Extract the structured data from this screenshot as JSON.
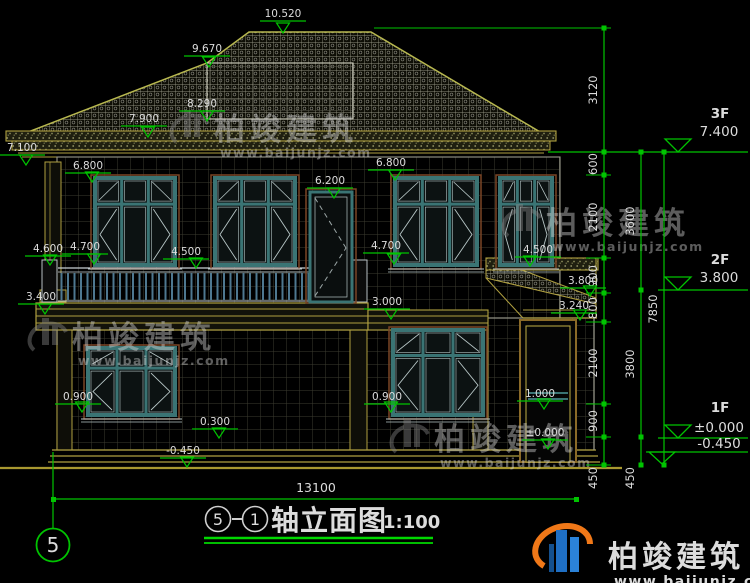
{
  "colors": {
    "background": "#000000",
    "dim_green": "#00c400",
    "text": "#dcdcdc",
    "roof_line": "#b8b850",
    "olive": "#b0a040",
    "wall_line": "#98988a",
    "window_frame": "#3a7474",
    "window_trim": "#7a4526",
    "pane_line": "#b7c6c6",
    "railing": "#4e7890",
    "watermark_gray": "#8a8a8a",
    "logo_blue": "#1f6fc4",
    "logo_orange": "#f07818"
  },
  "footer": {
    "title_axis_start": "5",
    "title_axis_end": "1",
    "title_text": "轴立面图",
    "title_scale": "1:100"
  },
  "axis_bubble": {
    "label": "5"
  },
  "overall_dim": {
    "label": "13100"
  },
  "watermark": {
    "brand": "柏竣建筑",
    "site": "www.baijunjz.com",
    "positions": [
      {
        "x": 166,
        "y": 102
      },
      {
        "x": 24,
        "y": 310
      },
      {
        "x": 498,
        "y": 196
      },
      {
        "x": 386,
        "y": 412
      }
    ]
  },
  "brand_logo": {
    "brand": "柏竣建筑",
    "site": "www.baijunjz.com"
  },
  "elevation_markers": [
    {
      "t": "10.520",
      "x": 283,
      "y": 17,
      "px": 283,
      "py": 33
    },
    {
      "t": "9.670",
      "x": 207,
      "y": 52,
      "px": 209,
      "py": 67
    },
    {
      "t": "8.290",
      "x": 202,
      "y": 107,
      "px": 207,
      "py": 121
    },
    {
      "t": "7.900",
      "x": 144,
      "y": 122,
      "px": 148,
      "py": 137
    },
    {
      "t": "7.100",
      "x": 22,
      "y": 151,
      "px": 26,
      "py": 165
    },
    {
      "t": "6.800",
      "x": 88,
      "y": 169,
      "px": 92,
      "py": 182
    },
    {
      "t": "6.800",
      "x": 391,
      "y": 166,
      "px": 395,
      "py": 180
    },
    {
      "t": "6.200",
      "x": 330,
      "y": 184,
      "px": 334,
      "py": 198
    },
    {
      "t": "4.700",
      "x": 85,
      "y": 250,
      "px": 94,
      "py": 264
    },
    {
      "t": "4.600",
      "x": 48,
      "y": 252,
      "px": 50,
      "py": 265
    },
    {
      "t": "4.500",
      "x": 186,
      "y": 255,
      "px": 196,
      "py": 268
    },
    {
      "t": "4.700",
      "x": 386,
      "y": 249,
      "px": 394,
      "py": 264
    },
    {
      "t": "4.500",
      "x": 538,
      "y": 253,
      "px": 530,
      "py": 266
    },
    {
      "t": "3.800",
      "x": 583,
      "y": 284,
      "px": 590,
      "py": 296
    },
    {
      "t": "3.400",
      "x": 41,
      "y": 300,
      "px": 45,
      "py": 314
    },
    {
      "t": "3.240",
      "x": 574,
      "y": 309,
      "px": 580,
      "py": 320
    },
    {
      "t": "3.000",
      "x": 387,
      "y": 305,
      "px": 391,
      "py": 319
    },
    {
      "t": "0.900",
      "x": 78,
      "y": 400,
      "px": 82,
      "py": 412
    },
    {
      "t": "0.900",
      "x": 387,
      "y": 400,
      "px": 391,
      "py": 412
    },
    {
      "t": "1.000",
      "x": 540,
      "y": 397,
      "px": 544,
      "py": 409
    },
    {
      "t": "±0.000",
      "x": 545,
      "y": 436,
      "px": 548,
      "py": 449
    },
    {
      "t": "0.300",
      "x": 215,
      "y": 425,
      "px": 219,
      "py": 438
    },
    {
      "t": "-0.450",
      "x": 183,
      "y": 454,
      "px": 187,
      "py": 467
    }
  ],
  "dim_chains": [
    {
      "x": 604,
      "y1": 28,
      "y2": 465,
      "ext": true,
      "ticks": [
        28,
        152,
        175,
        258,
        293,
        322,
        404,
        437,
        465
      ],
      "labels": [
        {
          "t": "3120",
          "y": 90
        },
        {
          "t": "600",
          "y": 164
        },
        {
          "t": "2100",
          "y": 217
        },
        {
          "t": "900",
          "y": 276
        },
        {
          "t": "800",
          "y": 308
        },
        {
          "t": "2100",
          "y": 363
        },
        {
          "t": "900",
          "y": 421
        },
        {
          "t": "450",
          "y": 478
        }
      ]
    },
    {
      "x": 641,
      "y1": 152,
      "y2": 465,
      "ext": false,
      "ticks": [
        152,
        290,
        437,
        465
      ],
      "labels": [
        {
          "t": "3600",
          "y": 221
        },
        {
          "t": "3800",
          "y": 364
        },
        {
          "t": "450",
          "y": 478
        }
      ]
    },
    {
      "x": 664,
      "y1": 152,
      "y2": 465,
      "ext": false,
      "ticks": [
        152,
        465
      ],
      "labels": [
        {
          "t": "7850",
          "y": 309
        }
      ]
    }
  ],
  "floor_levels": [
    {
      "name": "3F",
      "value": "7.400",
      "name_y": 118,
      "val_y": 136,
      "line_x1": 548,
      "line_y": 152,
      "tri_cx": 678,
      "tri_base": 139,
      "tri_tip": 152
    },
    {
      "name": "2F",
      "value": "3.800",
      "name_y": 264,
      "val_y": 282,
      "line_x1": 658,
      "line_y": 290,
      "tri_cx": 678,
      "tri_base": 277,
      "tri_tip": 290
    },
    {
      "name": "1F",
      "value": "±0.000",
      "name_y": 412,
      "val_y": 432,
      "line_x1": 658,
      "line_y": 438,
      "tri_cx": 678,
      "tri_base": 425,
      "tri_tip": 438
    },
    {
      "name": "",
      "value": "-0.450",
      "name_y": 0,
      "val_y": 448,
      "line_x1": 646,
      "line_y": 452,
      "tri_cx": 662,
      "tri_base": 452,
      "tri_tip": 464
    }
  ],
  "windows": [
    {
      "x": 95,
      "y": 178,
      "w": 80,
      "h": 87
    },
    {
      "x": 215,
      "y": 178,
      "w": 80,
      "h": 87
    },
    {
      "x": 395,
      "y": 178,
      "w": 82,
      "h": 87
    },
    {
      "x": 500,
      "y": 178,
      "w": 52,
      "h": 87
    },
    {
      "x": 88,
      "y": 348,
      "w": 87,
      "h": 67
    },
    {
      "x": 393,
      "y": 330,
      "w": 90,
      "h": 85
    }
  ]
}
